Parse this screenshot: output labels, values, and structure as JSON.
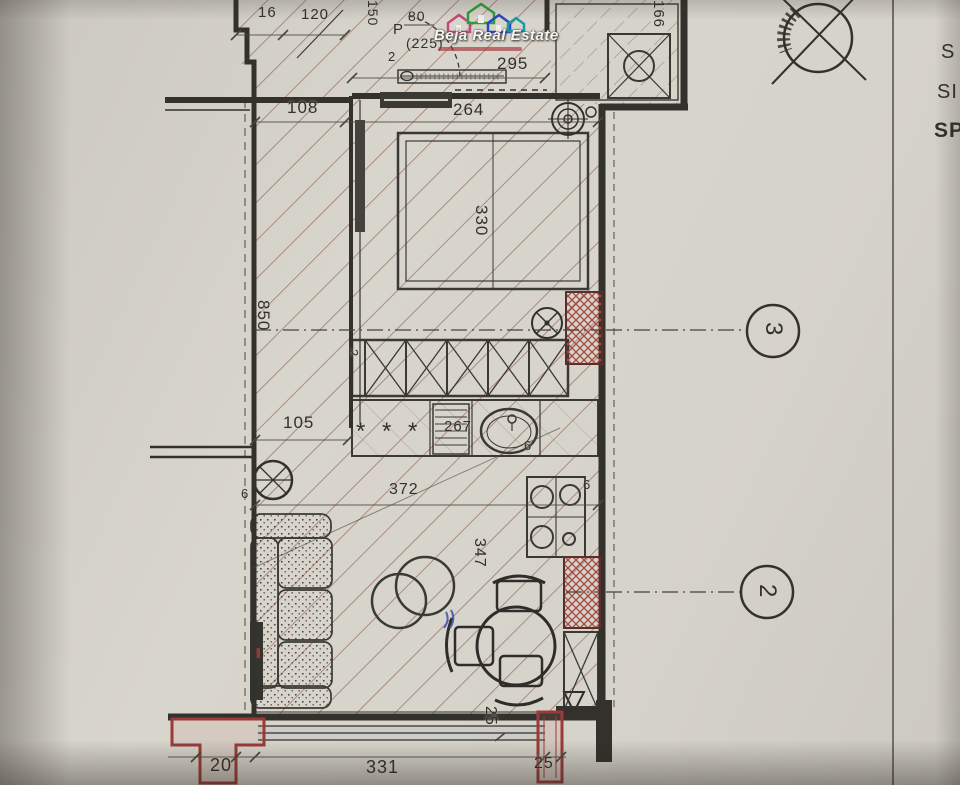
{
  "title": "Apartment floor plan blueprint photo",
  "logo": {
    "text": "Beja Real Estate"
  },
  "colors": {
    "house_pink": "#c2497a",
    "house_green": "#2f9e3c",
    "house_blue": "#2b46c0",
    "house_teal": "#149da6",
    "hatch_red": "#8a524d",
    "radiator_red": "#9c3a38",
    "paper": "#d6d3ca"
  },
  "labels": {
    "d16": "16",
    "d120": "120",
    "d150": "150",
    "d80": "80",
    "door_p": "P",
    "d225": "(225)",
    "d2_door": "2",
    "d295": "295",
    "d166": "166",
    "d108": "108",
    "d264": "264",
    "d330": "330",
    "d850": "850",
    "d2_kitchen": "2",
    "d105": "105",
    "d267": "267",
    "stars": "* * *",
    "d372": "372",
    "d347": "347",
    "six_wall": "6",
    "six_sink": "6",
    "six_stove": "6",
    "d20": "20",
    "d331": "331",
    "d25_vert": "25",
    "d25_col": "25"
  },
  "grid_markers": {
    "marker_3": "3",
    "marker_2": "2"
  },
  "edge_text": {
    "line1": "S",
    "line2": "SI",
    "line3": "SP"
  }
}
